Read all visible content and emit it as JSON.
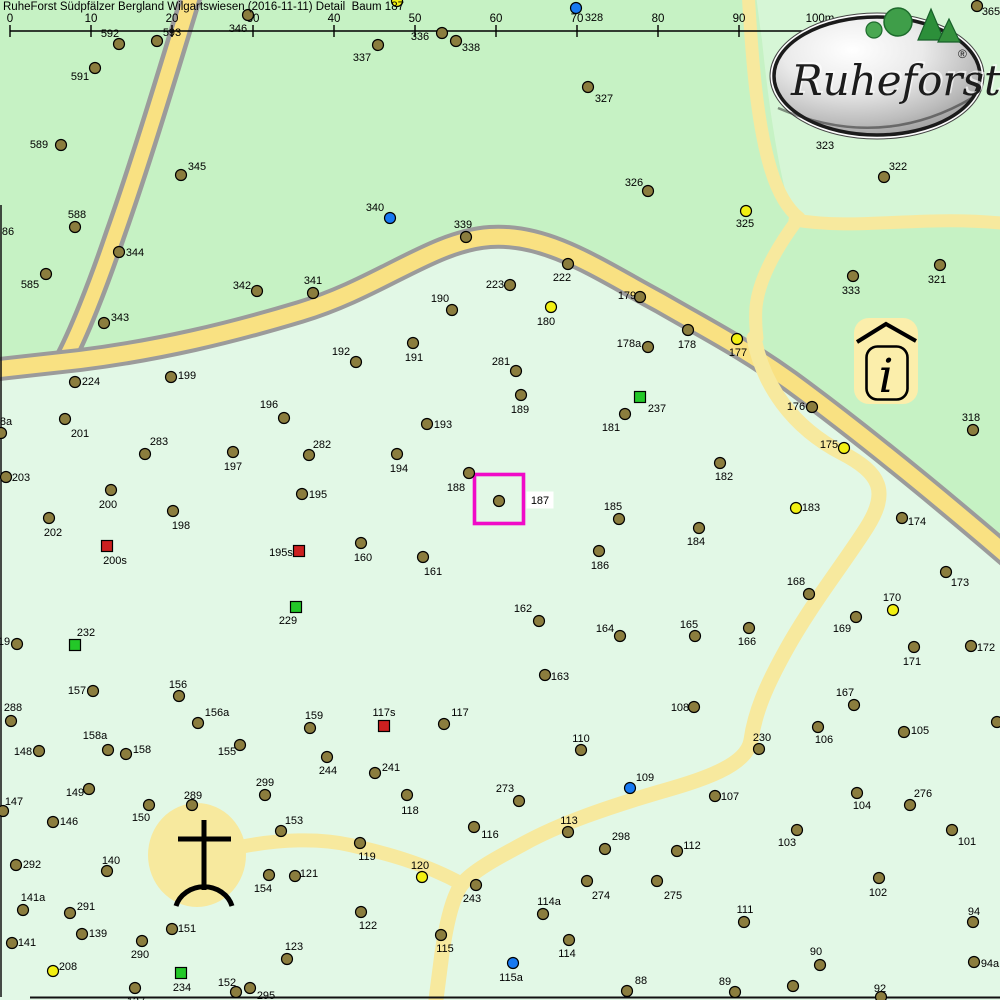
{
  "header": {
    "title": "RuheForst Südpfälzer Bergland Wilgartswiesen (2016-11-11) Detail  Baum 187"
  },
  "ruler": {
    "labels": [
      "0",
      "10",
      "20",
      "30",
      "40",
      "50",
      "60",
      "70",
      "80",
      "90",
      "100m"
    ],
    "x_start": 10,
    "spacing": 81,
    "line_y": 31
  },
  "logo": {
    "text": "Ruheforst",
    "registered": "®"
  },
  "info_icon": {
    "glyph": "i"
  },
  "selection": {
    "tree_id": "187",
    "box": {
      "x": 474.5,
      "y": 474.5,
      "w": 49,
      "h": 49
    },
    "label_x": 540,
    "label_y": 504,
    "color": "#f00ac8"
  },
  "colors": {
    "medium_green": "#c6f2c4",
    "light_green": "#e2f8e6",
    "lighter_green": "#d6f6d6",
    "road_fill": "#f9e182",
    "road_casing": "#9b9b9b",
    "path_fill": "#f7e99e",
    "tree_tan": "#8b7d3e",
    "tree_yellow": "#f2f011",
    "tree_blue": "#1779f2",
    "square_red": "#cc2020",
    "square_green": "#23c828",
    "label_color": "#000000"
  },
  "map": {
    "trees": [
      [
        "592",
        "t",
        119,
        44,
        110,
        33
      ],
      [
        "593",
        "t",
        157,
        41,
        172,
        32
      ],
      [
        "346",
        "t",
        248,
        15,
        238,
        28
      ],
      [
        "337",
        "t",
        378,
        45,
        362,
        57
      ],
      [
        "336",
        "t",
        442,
        33,
        420,
        36
      ],
      [
        "338",
        "t",
        456,
        41,
        471,
        47
      ],
      [
        "328",
        "b",
        576,
        8,
        594,
        17
      ],
      [
        "",
        "y",
        397,
        1,
        null,
        null
      ],
      [
        "365",
        "t",
        977,
        6,
        991,
        11
      ],
      [
        "591",
        "t",
        95,
        68,
        80,
        76
      ],
      [
        "589",
        "t",
        61,
        145,
        39,
        144
      ],
      [
        "345",
        "t",
        181,
        175,
        197,
        166
      ],
      [
        "588",
        "t",
        75,
        227,
        77,
        214
      ],
      [
        "86",
        "l",
        null,
        null,
        8,
        231
      ],
      [
        "344",
        "t",
        119,
        252,
        135,
        252
      ],
      [
        "585",
        "t",
        46,
        274,
        30,
        284
      ],
      [
        "343",
        "t",
        104,
        323,
        120,
        317
      ],
      [
        "342",
        "t",
        257,
        291,
        242,
        285
      ],
      [
        "341",
        "t",
        313,
        293,
        313,
        280
      ],
      [
        "340",
        "b",
        390,
        218,
        375,
        207
      ],
      [
        "339",
        "t",
        466,
        237,
        463,
        224
      ],
      [
        "327",
        "t",
        588,
        87,
        604,
        98
      ],
      [
        "326",
        "t",
        648,
        191,
        634,
        182
      ],
      [
        "325",
        "y",
        746,
        211,
        745,
        223
      ],
      [
        "323",
        "l",
        null,
        null,
        825,
        145
      ],
      [
        "322",
        "t",
        884,
        177,
        898,
        166
      ],
      [
        "333",
        "t",
        853,
        276,
        851,
        290
      ],
      [
        "321",
        "t",
        940,
        265,
        937,
        279
      ],
      [
        "318",
        "t",
        973,
        430,
        971,
        417
      ],
      [
        "222",
        "t",
        568,
        264,
        562,
        277
      ],
      [
        "223",
        "t",
        510,
        285,
        495,
        284
      ],
      [
        "190",
        "t",
        452,
        310,
        440,
        298
      ],
      [
        "180",
        "y",
        551,
        307,
        546,
        321
      ],
      [
        "179",
        "t",
        640,
        297,
        627,
        295
      ],
      [
        "178a",
        "t",
        648,
        347,
        629,
        343
      ],
      [
        "178",
        "t",
        688,
        330,
        687,
        344
      ],
      [
        "177",
        "y",
        737,
        339,
        738,
        352
      ],
      [
        "176",
        "t",
        812,
        407,
        796,
        406
      ],
      [
        "175",
        "y",
        844,
        448,
        829,
        444
      ],
      [
        "224",
        "t",
        75,
        382,
        91,
        381
      ],
      [
        "199",
        "t",
        171,
        377,
        187,
        375
      ],
      [
        "192",
        "t",
        356,
        362,
        341,
        351
      ],
      [
        "191",
        "t",
        413,
        343,
        414,
        357
      ],
      [
        "281",
        "t",
        516,
        371,
        501,
        361
      ],
      [
        "189",
        "t",
        521,
        395,
        520,
        409
      ],
      [
        "201",
        "t",
        65,
        419,
        80,
        433
      ],
      [
        "8a",
        "t",
        1,
        433,
        6,
        421
      ],
      [
        "283",
        "t",
        145,
        454,
        159,
        441
      ],
      [
        "197",
        "t",
        233,
        452,
        233,
        466
      ],
      [
        "196",
        "t",
        284,
        418,
        269,
        404
      ],
      [
        "193",
        "t",
        427,
        424,
        443,
        424
      ],
      [
        "203",
        "t",
        6,
        477,
        21,
        477
      ],
      [
        "282",
        "t",
        309,
        455,
        322,
        444
      ],
      [
        "194",
        "t",
        397,
        454,
        399,
        468
      ],
      [
        "200",
        "t",
        111,
        490,
        108,
        504
      ],
      [
        "188",
        "t",
        469,
        473,
        456,
        487
      ],
      [
        "187",
        "t",
        499,
        501,
        null,
        null
      ],
      [
        "198",
        "t",
        173,
        511,
        181,
        525
      ],
      [
        "202",
        "t",
        49,
        518,
        53,
        532
      ],
      [
        "185",
        "t",
        619,
        519,
        613,
        506
      ],
      [
        "182",
        "t",
        720,
        463,
        724,
        476
      ],
      [
        "237",
        "g",
        640,
        397,
        657,
        408
      ],
      [
        "181",
        "t",
        625,
        414,
        611,
        427
      ],
      [
        "174",
        "t",
        902,
        518,
        917,
        521
      ],
      [
        "183",
        "y",
        796,
        508,
        811,
        507
      ],
      [
        "200s",
        "r",
        107,
        546,
        115,
        560
      ],
      [
        "195",
        "t",
        302,
        494,
        318,
        494
      ],
      [
        "195s",
        "r",
        299,
        551,
        281,
        552
      ],
      [
        "160",
        "t",
        361,
        543,
        363,
        557
      ],
      [
        "161",
        "t",
        423,
        557,
        433,
        571
      ],
      [
        "186",
        "t",
        599,
        551,
        600,
        565
      ],
      [
        "184",
        "t",
        699,
        528,
        696,
        541
      ],
      [
        "173",
        "t",
        946,
        572,
        960,
        582
      ],
      [
        "168",
        "t",
        809,
        594,
        796,
        581
      ],
      [
        "170",
        "y",
        893,
        610,
        892,
        597
      ],
      [
        "169",
        "t",
        856,
        617,
        842,
        628
      ],
      [
        "171",
        "t",
        914,
        647,
        912,
        661
      ],
      [
        "172",
        "t",
        971,
        646,
        986,
        647
      ],
      [
        "162",
        "t",
        539,
        621,
        523,
        608
      ],
      [
        "164",
        "t",
        620,
        636,
        605,
        628
      ],
      [
        "165",
        "t",
        695,
        636,
        689,
        624
      ],
      [
        "166",
        "t",
        749,
        628,
        747,
        641
      ],
      [
        "232",
        "g",
        75,
        645,
        86,
        632
      ],
      [
        "19",
        "t",
        17,
        644,
        4,
        641
      ],
      [
        "163",
        "t",
        545,
        675,
        560,
        676
      ],
      [
        "157",
        "t",
        93,
        691,
        77,
        690
      ],
      [
        "156",
        "t",
        179,
        696,
        178,
        684
      ],
      [
        "108",
        "t",
        694,
        707,
        680,
        707
      ],
      [
        "288",
        "t",
        11,
        721,
        13,
        707
      ],
      [
        "156a",
        "t",
        198,
        723,
        217,
        712
      ],
      [
        "167",
        "t",
        854,
        705,
        845,
        692
      ],
      [
        "106",
        "t",
        818,
        727,
        824,
        739
      ],
      [
        "105",
        "t",
        904,
        732,
        920,
        730
      ],
      [
        "",
        "t",
        997,
        722,
        null,
        null
      ],
      [
        "230",
        "t",
        759,
        749,
        762,
        737
      ],
      [
        "148",
        "t",
        39,
        751,
        23,
        751
      ],
      [
        "158a",
        "t",
        108,
        750,
        95,
        735
      ],
      [
        "158",
        "t",
        126,
        754,
        142,
        749
      ],
      [
        "155",
        "t",
        240,
        745,
        227,
        751
      ],
      [
        "244",
        "t",
        327,
        757,
        328,
        770
      ],
      [
        "159",
        "t",
        310,
        728,
        314,
        715
      ],
      [
        "117s",
        "r",
        384,
        726,
        384,
        712
      ],
      [
        "117",
        "t",
        444,
        724,
        460,
        712
      ],
      [
        "241",
        "t",
        375,
        773,
        391,
        767
      ],
      [
        "110",
        "t",
        581,
        750,
        581,
        738
      ],
      [
        "109",
        "b",
        630,
        788,
        645,
        777
      ],
      [
        "107",
        "t",
        715,
        796,
        730,
        796
      ],
      [
        "104",
        "t",
        857,
        793,
        862,
        805
      ],
      [
        "276",
        "t",
        910,
        805,
        923,
        793
      ],
      [
        "103",
        "t",
        797,
        830,
        787,
        842
      ],
      [
        "101",
        "t",
        952,
        830,
        967,
        841
      ],
      [
        "102",
        "t",
        879,
        878,
        878,
        892
      ],
      [
        "149",
        "t",
        89,
        789,
        75,
        792
      ],
      [
        "147",
        "t",
        3,
        811,
        14,
        801
      ],
      [
        "289",
        "t",
        192,
        805,
        193,
        795
      ],
      [
        "150",
        "t",
        149,
        805,
        141,
        817
      ],
      [
        "146",
        "t",
        53,
        822,
        69,
        821
      ],
      [
        "299",
        "t",
        265,
        795,
        265,
        782
      ],
      [
        "153",
        "t",
        281,
        831,
        294,
        820
      ],
      [
        "118",
        "t",
        407,
        795,
        410,
        810
      ],
      [
        "273",
        "t",
        519,
        801,
        505,
        788
      ],
      [
        "116",
        "t",
        474,
        827,
        490,
        834
      ],
      [
        "119",
        "t",
        360,
        843,
        367,
        856
      ],
      [
        "292",
        "t",
        16,
        865,
        32,
        864
      ],
      [
        "140",
        "t",
        107,
        871,
        111,
        860
      ],
      [
        "120",
        "y",
        422,
        877,
        420,
        865
      ],
      [
        "243",
        "t",
        476,
        885,
        472,
        898
      ],
      [
        "113",
        "t",
        568,
        832,
        569,
        820
      ],
      [
        "298",
        "t",
        605,
        849,
        621,
        836
      ],
      [
        "112",
        "t",
        677,
        851,
        692,
        845
      ],
      [
        "154",
        "t",
        269,
        875,
        263,
        888
      ],
      [
        "121",
        "t",
        295,
        876,
        309,
        873
      ],
      [
        "141a",
        "t",
        23,
        910,
        33,
        897
      ],
      [
        "291",
        "t",
        70,
        913,
        86,
        906
      ],
      [
        "274",
        "t",
        587,
        881,
        601,
        895
      ],
      [
        "275",
        "t",
        657,
        881,
        673,
        895
      ],
      [
        "111",
        "t",
        744,
        922,
        745,
        909
      ],
      [
        "139",
        "t",
        82,
        934,
        98,
        933
      ],
      [
        "151",
        "t",
        172,
        929,
        187,
        928
      ],
      [
        "114a",
        "t",
        543,
        914,
        549,
        901
      ],
      [
        "94",
        "t",
        973,
        922,
        974,
        911
      ],
      [
        "141",
        "t",
        12,
        943,
        27,
        942
      ],
      [
        "290",
        "t",
        142,
        941,
        140,
        954
      ],
      [
        "114",
        "t",
        569,
        940,
        567,
        953
      ],
      [
        "123",
        "t",
        287,
        959,
        294,
        946
      ],
      [
        "122",
        "t",
        361,
        912,
        368,
        925
      ],
      [
        "115",
        "t",
        441,
        935,
        445,
        948
      ],
      [
        "88",
        "t",
        627,
        991,
        641,
        980
      ],
      [
        "89",
        "t",
        735,
        992,
        725,
        981
      ],
      [
        "115a",
        "b",
        513,
        963,
        511,
        977
      ],
      [
        "90",
        "t",
        820,
        965,
        816,
        951
      ],
      [
        "94a",
        "t",
        974,
        962,
        990,
        963
      ],
      [
        "208",
        "y",
        53,
        971,
        68,
        966
      ],
      [
        "234",
        "g",
        181,
        973,
        182,
        987
      ],
      [
        "152",
        "t",
        236,
        992,
        227,
        982
      ],
      [
        "295",
        "t",
        250,
        988,
        266,
        995
      ],
      [
        "137",
        "t",
        135,
        988,
        136,
        1001
      ],
      [
        "92",
        "t",
        881,
        997,
        880,
        988
      ],
      [
        "",
        "t",
        793,
        986,
        null,
        null
      ],
      [
        "229",
        "g",
        296,
        607,
        288,
        620
      ]
    ]
  }
}
